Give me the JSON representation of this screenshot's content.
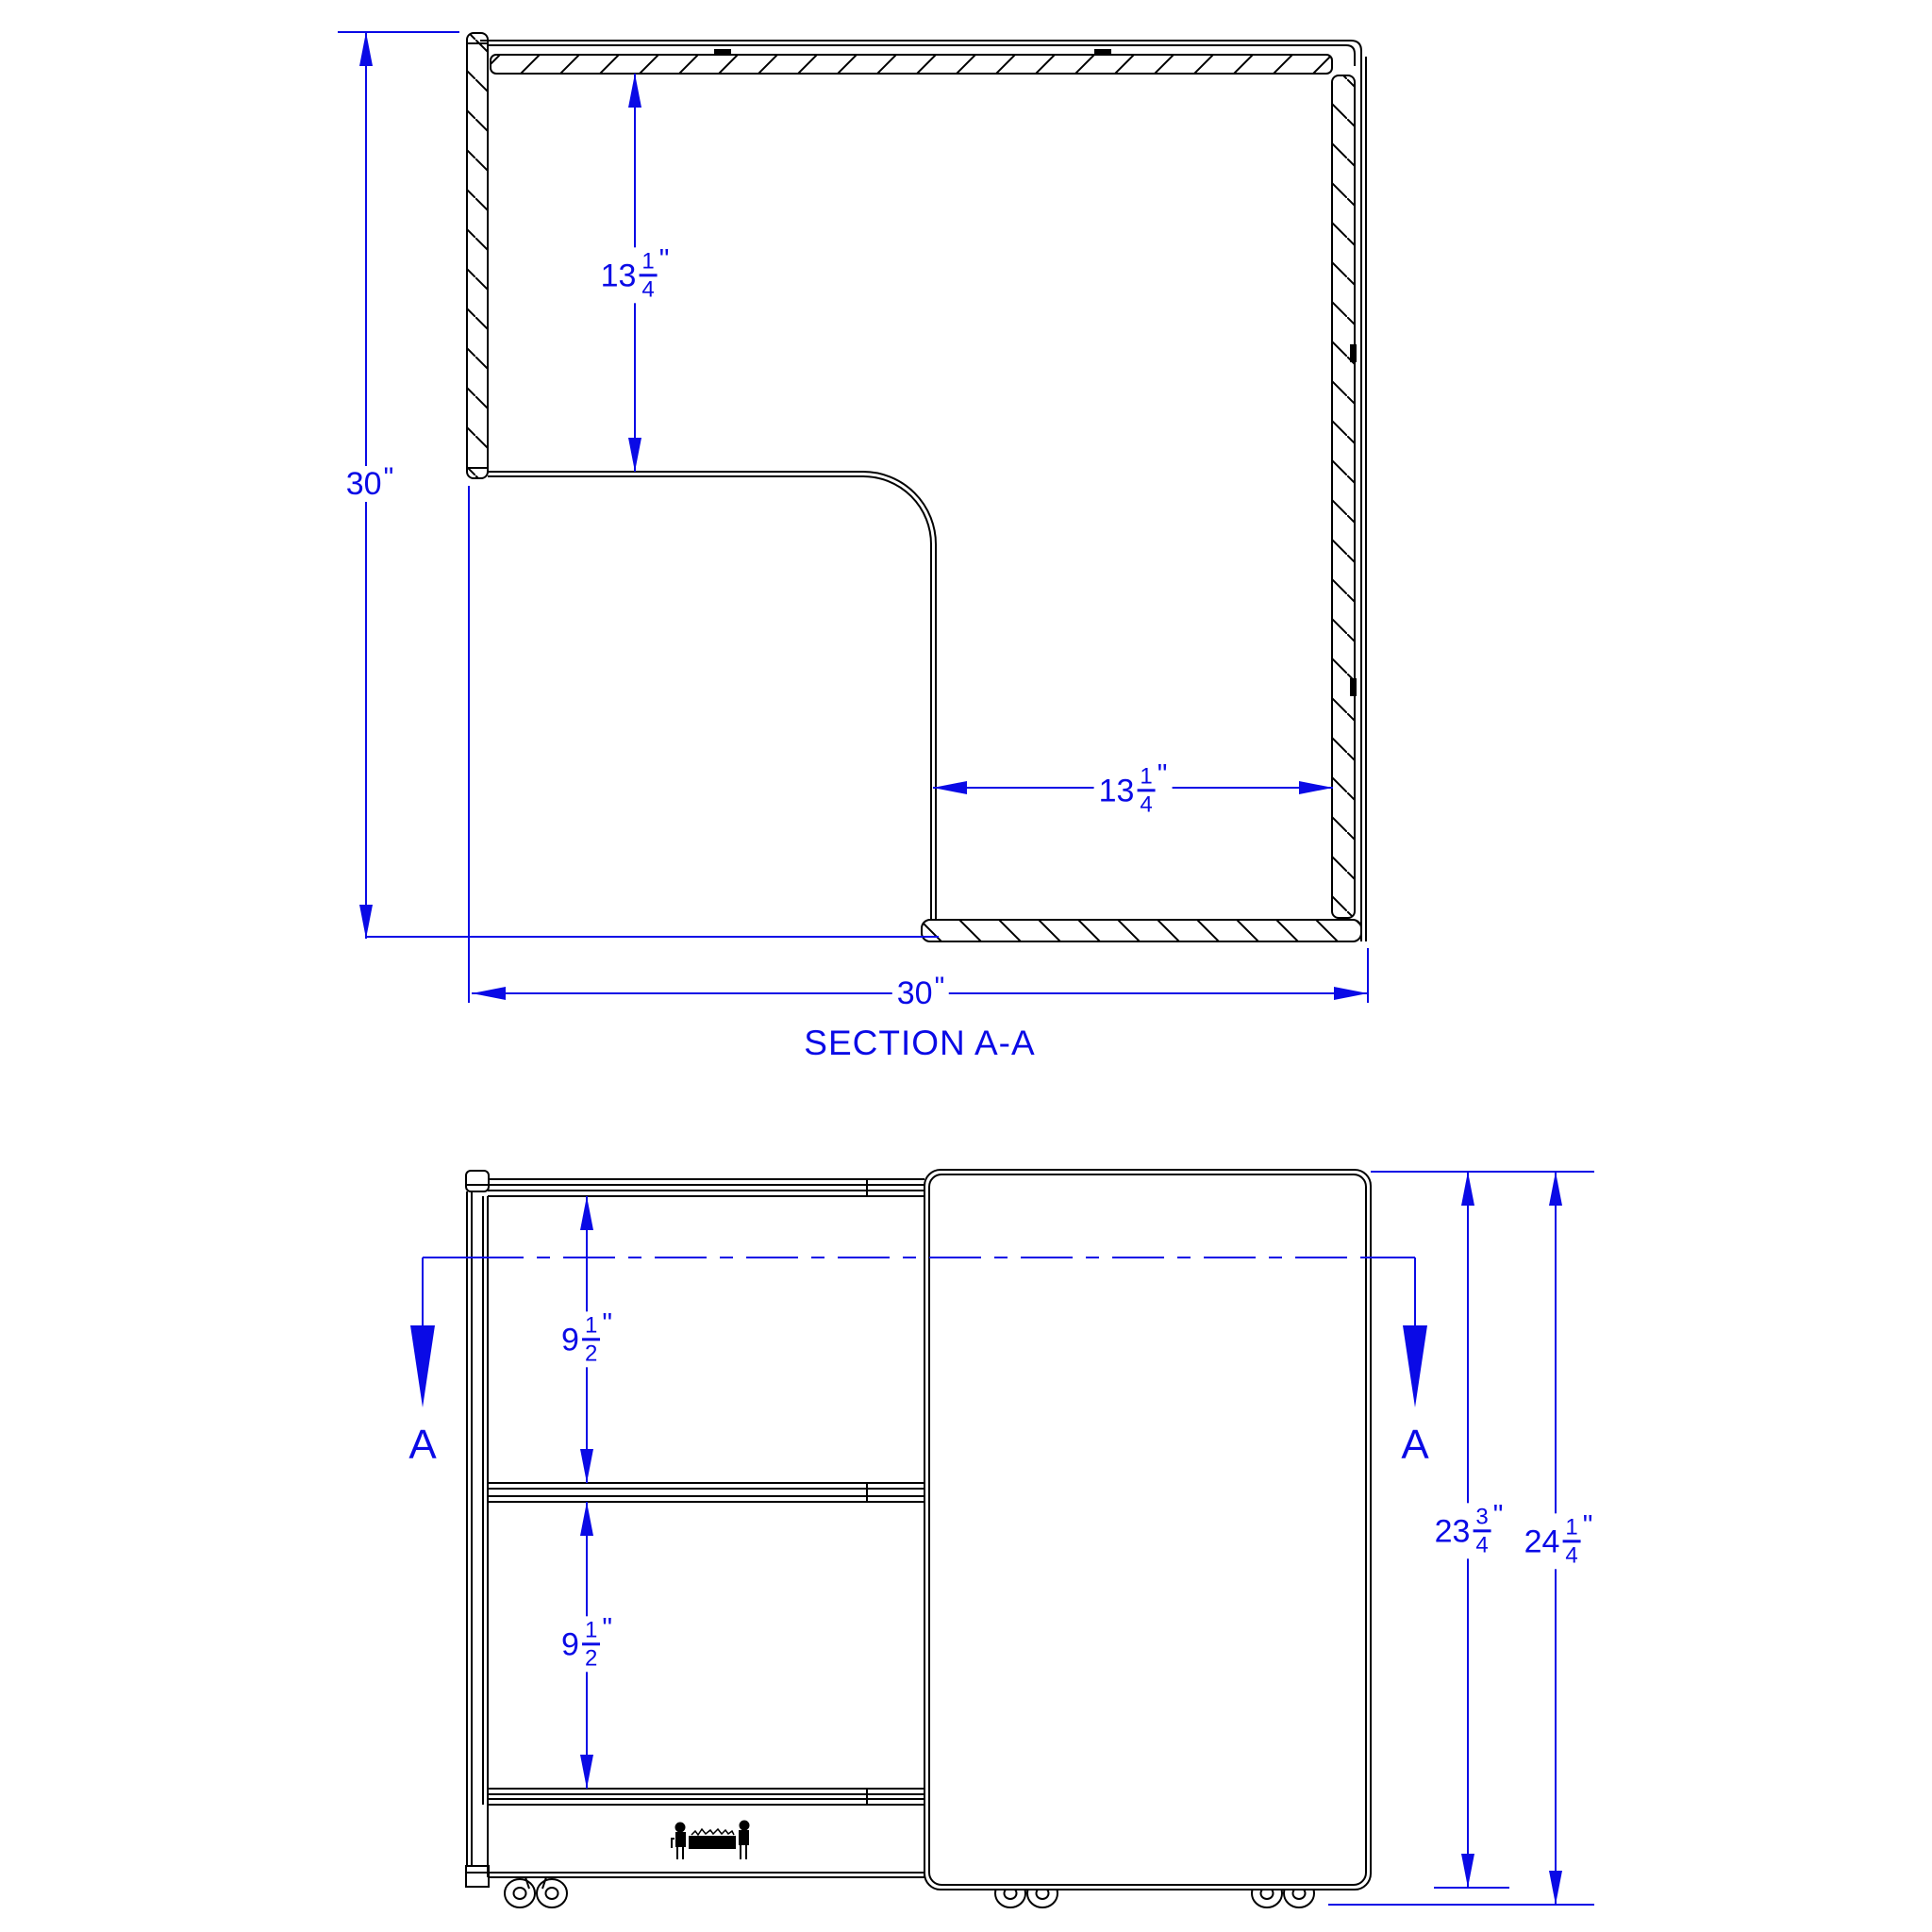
{
  "drawing": {
    "title": "SECTION A-A",
    "colors": {
      "dimension_blue": "#0a0ae6",
      "line_black": "#000000",
      "background": "#ffffff"
    },
    "icons": {
      "brand_emblem": "workbench-figures-logo",
      "section_cut_arrow": "solid-triangle-down",
      "caster": "double-wheel-caster"
    },
    "section_view": {
      "name": "SECTION A-A",
      "dim_overall_height": {
        "whole": "30",
        "unit": "\""
      },
      "dim_top_panel_depth": {
        "whole": "13",
        "numerator": "1",
        "denominator": "4",
        "unit": "\""
      },
      "dim_right_panel_depth": {
        "whole": "13",
        "numerator": "1",
        "denominator": "4",
        "unit": "\""
      },
      "dim_overall_width": {
        "whole": "30",
        "unit": "\""
      }
    },
    "front_view": {
      "cut_label_left": "A",
      "cut_label_right": "A",
      "dim_shelf_spacing_upper": {
        "whole": "9",
        "numerator": "1",
        "denominator": "2",
        "unit": "\""
      },
      "dim_shelf_spacing_lower": {
        "whole": "9",
        "numerator": "1",
        "denominator": "2",
        "unit": "\""
      },
      "dim_body_height": {
        "whole": "23",
        "numerator": "3",
        "denominator": "4",
        "unit": "\""
      },
      "dim_overall_height": {
        "whole": "24",
        "numerator": "1",
        "denominator": "4",
        "unit": "\""
      }
    }
  }
}
